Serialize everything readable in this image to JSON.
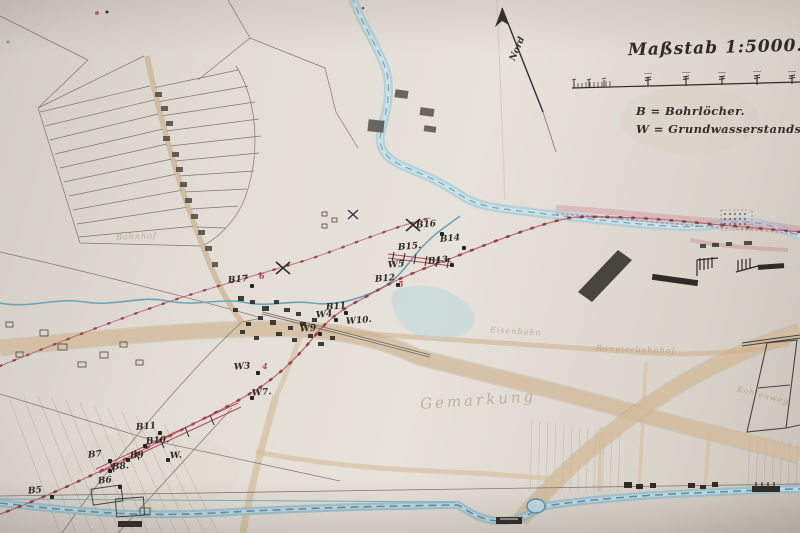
{
  "title": {
    "text": "Maßstab 1:5000."
  },
  "legend": {
    "line1": "B = Bohrlöcher.",
    "line2": "W = Grundwasserstandsrohre."
  },
  "compass": {
    "label": "Nord"
  },
  "map": {
    "colors": {
      "paper": "#e0dbd3",
      "ink": "#4a443e",
      "water_fill": "#a8ccd8",
      "water_line": "#5e93a8",
      "road_tan": "#d6bd9c",
      "survey_red": "#b04a56",
      "pink_wash": "#cf7f8f",
      "label_ink": "#2e2a26",
      "faded_brown": "#9b8063"
    },
    "points": [
      {
        "text": "B16",
        "x": 416,
        "y": 221,
        "dot": [
          440,
          232
        ]
      },
      {
        "text": "B14",
        "x": 440,
        "y": 235,
        "dot": [
          462,
          246
        ]
      },
      {
        "text": "B15.",
        "x": 398,
        "y": 243
      },
      {
        "text": "B13",
        "x": 428,
        "y": 257,
        "dot": [
          450,
          263
        ]
      },
      {
        "text": "W5",
        "x": 388,
        "y": 261
      },
      {
        "text": "B12",
        "x": 375,
        "y": 275,
        "dot": [
          396,
          283
        ]
      },
      {
        "text": "B17",
        "x": 228,
        "y": 276,
        "dot": [
          250,
          284
        ]
      },
      {
        "text": "B11",
        "x": 326,
        "y": 303,
        "dot": [
          344,
          311
        ]
      },
      {
        "text": "W4",
        "x": 316,
        "y": 311,
        "dot": [
          334,
          318
        ]
      },
      {
        "text": "W10.",
        "x": 346,
        "y": 317
      },
      {
        "text": "W9",
        "x": 300,
        "y": 325,
        "dot": [
          318,
          332
        ]
      },
      {
        "text": "W3",
        "x": 234,
        "y": 363,
        "dot": [
          256,
          371
        ]
      },
      {
        "text": "W7.",
        "x": 252,
        "y": 389,
        "dot": [
          250,
          396
        ]
      },
      {
        "text": "B11",
        "x": 136,
        "y": 423,
        "dot": [
          158,
          431
        ]
      },
      {
        "text": "B10.",
        "x": 146,
        "y": 437,
        "dot": [
          143,
          444
        ]
      },
      {
        "text": "B9",
        "x": 130,
        "y": 452,
        "dot": [
          126,
          458
        ]
      },
      {
        "text": "B7",
        "x": 88,
        "y": 451,
        "dot": [
          108,
          459
        ]
      },
      {
        "text": "W.",
        "x": 170,
        "y": 452,
        "dot": [
          166,
          458
        ]
      },
      {
        "text": "B8.",
        "x": 112,
        "y": 463,
        "dot": [
          108,
          469
        ]
      },
      {
        "text": "B6",
        "x": 98,
        "y": 477,
        "dot": [
          118,
          485
        ]
      },
      {
        "text": "B5",
        "x": 28,
        "y": 487,
        "dot": [
          50,
          495
        ]
      }
    ],
    "red_numbers": [
      {
        "text": "6",
        "x": 259,
        "y": 272
      },
      {
        "text": "5",
        "x": 398,
        "y": 280
      },
      {
        "text": "4",
        "x": 262,
        "y": 362
      }
    ],
    "faint_labels": [
      {
        "text": "Gemarkung",
        "x": 420,
        "y": 393,
        "size": 15,
        "rot": -4,
        "ls": 3
      },
      {
        "text": "Rangierbahnhof",
        "x": 596,
        "y": 346,
        "size": 8,
        "rot": 2,
        "ls": 1
      },
      {
        "text": "Eisenbahn",
        "x": 490,
        "y": 328,
        "size": 8,
        "rot": 4,
        "ls": 1
      },
      {
        "text": "Kohlenweg",
        "x": 736,
        "y": 392,
        "size": 8,
        "rot": 14,
        "ls": 1
      },
      {
        "text": "Bahnhof",
        "x": 116,
        "y": 233,
        "size": 8,
        "rot": -3,
        "ls": 1
      }
    ]
  }
}
